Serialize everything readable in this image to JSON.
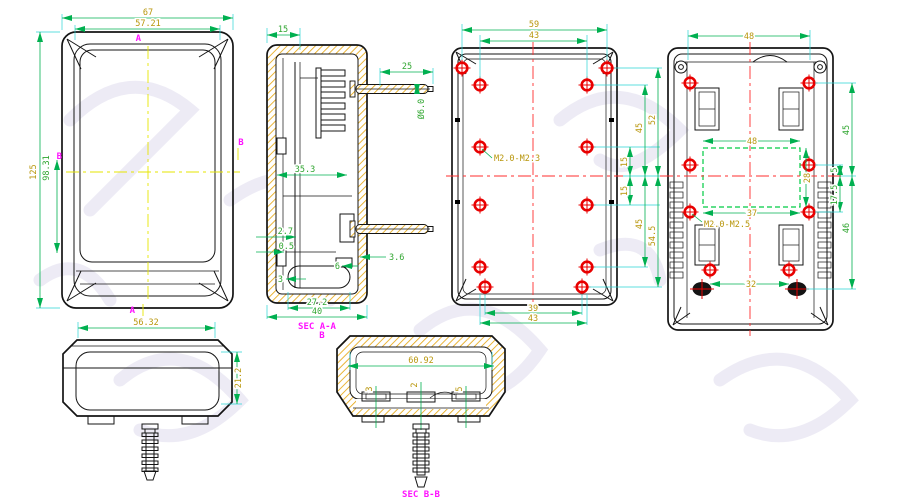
{
  "colors": {
    "outline": "#141414",
    "dimension_line_green": "#00b050",
    "dimension_text_gold": "#b8960b",
    "dimension_text_green": "#2fa52f",
    "extension_cyan": "#2ad4d4",
    "centerline_yellow": "#e6e600",
    "centerline_red": "#ff2d2d",
    "screw_red": "#e80000",
    "section_hatch_gold": "#e6a817",
    "section_label_magenta": "#ff12ff",
    "dashed_window_green": "#00cc44"
  },
  "views": {
    "front": {
      "dims": {
        "outer_width": "67",
        "inner_width": "57.21",
        "outer_height": "125",
        "inner_height": "98.31"
      },
      "markers": {
        "top": "A",
        "bottom": "A",
        "left": "B",
        "right": "B"
      }
    },
    "side": {
      "dims": {
        "width": "56.32",
        "height": "21.2"
      }
    },
    "section_aa": {
      "label": "SEC A-A",
      "dims": {
        "wall_offset": "15",
        "anchor_length": "25",
        "anchor_diameter": "Ø6.0",
        "inner_width": "35.3",
        "rib_thickness": "2.7",
        "gap": "0.5",
        "clip": "3.6",
        "boss_height": "6",
        "foot": "3",
        "slot_width": "27.2",
        "base_width": "40"
      }
    },
    "inner": {
      "thread_label": "M2.0-M2.3",
      "dims": {
        "outer_width": "59",
        "boss_width": "43",
        "right_upper_span": "45",
        "right_upper_outer": "52",
        "right_mid_upper": "15",
        "right_mid_lower": "15",
        "right_lower_span": "45",
        "right_lower_outer": "54.5",
        "bottom_boss_width": "39",
        "bottom_width": "43"
      }
    },
    "back": {
      "thread_label": "M2.0-M2.5",
      "dims": {
        "top_width": "48",
        "window_width": "48",
        "window_height": "28",
        "window_bottom_width": "37",
        "bottom_width": "32",
        "right_span": "45",
        "right_offset": "5",
        "right_mid": "17.5",
        "right_lower": "46"
      }
    },
    "section_bb": {
      "label": "SEC B-B",
      "marker": "B",
      "dims": {
        "inner_width": "60.92",
        "clip_left": "3",
        "clip_center": "2",
        "clip_right": "5"
      }
    }
  }
}
